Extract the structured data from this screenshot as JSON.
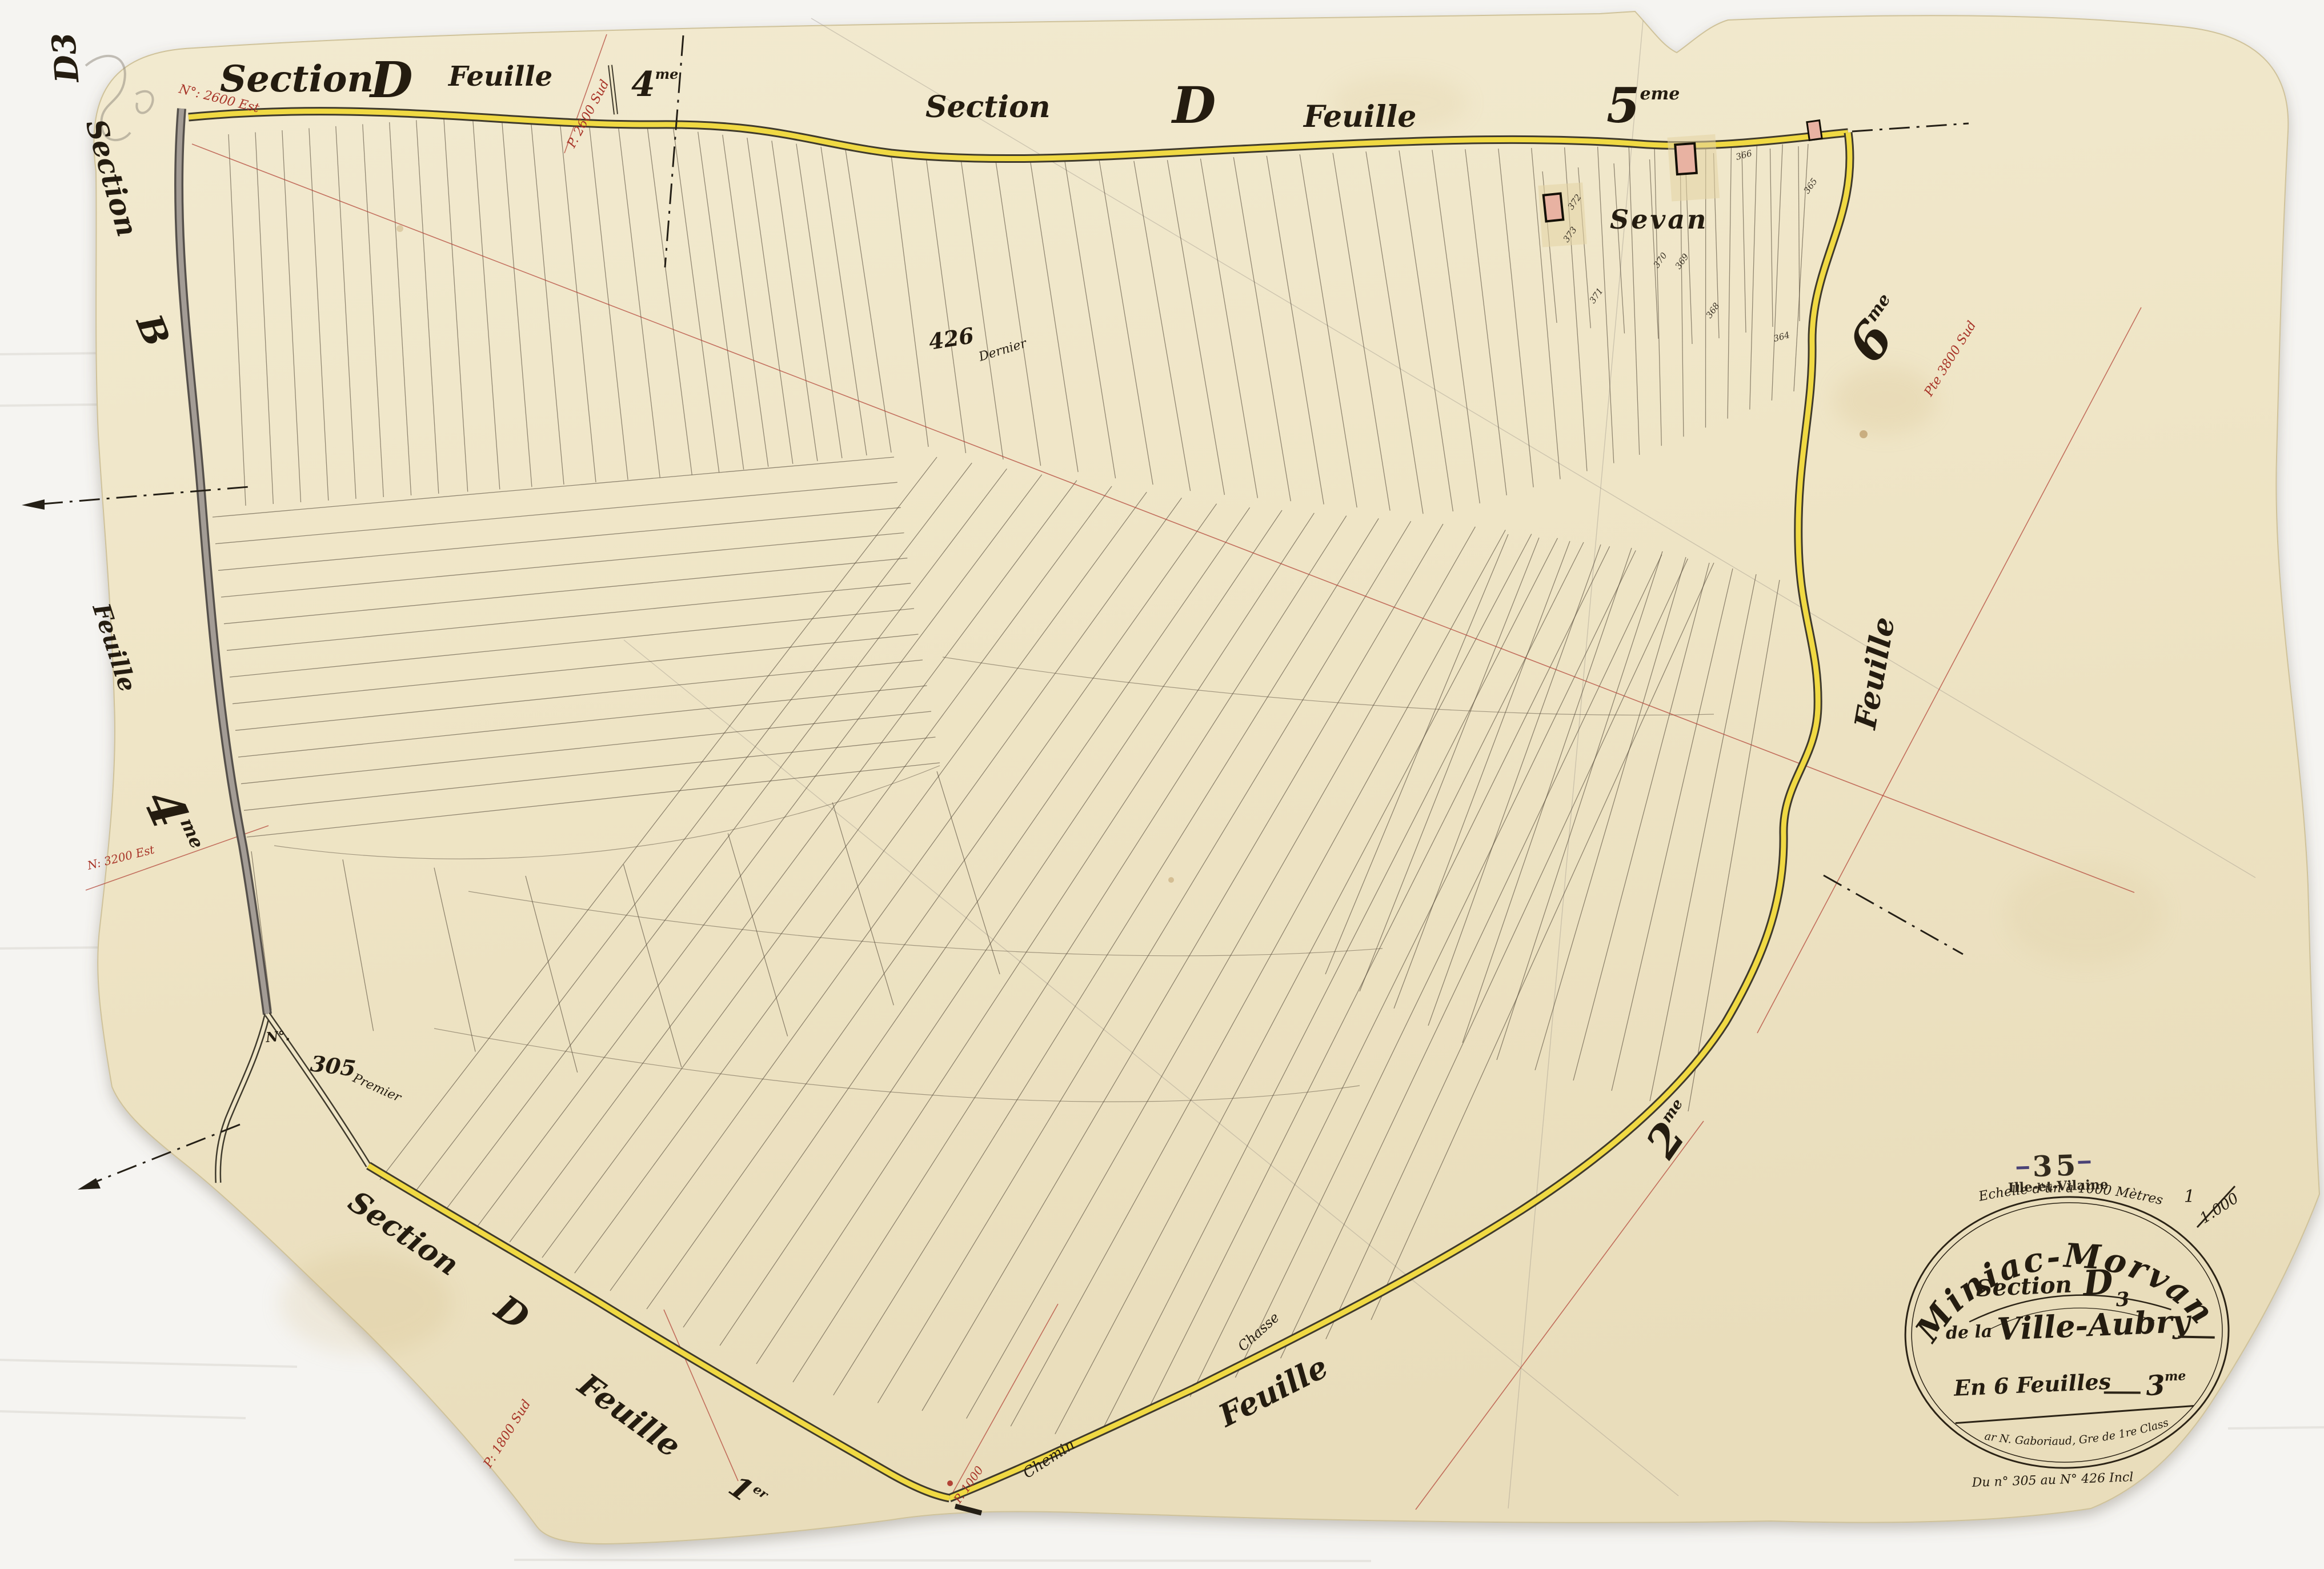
{
  "sheet": {
    "corner_mark": "D3",
    "village": "Sevan",
    "edge_labels": {
      "top_left": {
        "section": "Section",
        "letter": "D",
        "feuille": "Feuille",
        "num": "4",
        "sup": "me"
      },
      "top_center": {
        "section": "Section",
        "letter": "D",
        "feuille": "Feuille",
        "num": "5",
        "sup": "eme"
      },
      "left": {
        "section": "Section",
        "letter": "B",
        "feuille": "Feuille",
        "num": "4",
        "sup": "me"
      },
      "bottom_left": {
        "section": "Section",
        "letter": "D",
        "feuille": "Feuille",
        "num": "1",
        "sup": "er"
      },
      "bottom_center": {
        "feuille": "Feuille"
      },
      "right": {
        "num6": "6",
        "sup6": "me",
        "feuille": "Feuille",
        "num2": "2",
        "sup2": "me"
      }
    },
    "parcels": {
      "first": {
        "no": "N°.",
        "num": "305",
        "word": "Premier"
      },
      "last": {
        "num": "426",
        "word": "Dernier"
      },
      "small": [
        {
          "n": "372"
        },
        {
          "n": "373"
        },
        {
          "n": "371"
        },
        {
          "n": "370"
        },
        {
          "n": "369"
        },
        {
          "n": "368"
        },
        {
          "n": "366"
        },
        {
          "n": "365"
        },
        {
          "n": "364"
        }
      ]
    },
    "road_labels": {
      "chasse": "Chasse",
      "chemin": "Chemin"
    },
    "red_annotations": {
      "r1": "N°: 2600 Est",
      "r2": "P. 2600 Sud",
      "r3": "Pte 3800 Sud",
      "r4": "N: 3200 Est",
      "r5": "P: 1800 Sud",
      "r6": "P. 1000"
    },
    "cartouche": {
      "commune": "Miniac-Morvan",
      "section_label": "Section",
      "section_letter": "D",
      "section_sub": "3",
      "line2_prefix": "de la",
      "line2_name": "Ville-Aubry",
      "line3": "En 6 Feuilles",
      "line3_num": "3",
      "line3_sup": "me",
      "surveyor": "Par N. Gaboriaud, Gre de 1re Classe",
      "range": "Du n° 305 au N° 426 Incl",
      "scale_text": "Echelle d'un à 1000 Mètres",
      "frac_top": "1",
      "frac_bottom": "1.000"
    },
    "stamp": {
      "code": "35",
      "name": "Ille-et-Vilaine"
    },
    "colors": {
      "road_yellow": "#f0d943",
      "ink": "#241c10",
      "red_ink": "#a83428",
      "stamp_purple": "#5a4da5",
      "stamp_dark": "#3d3570",
      "paper": "#efe5c6"
    }
  }
}
